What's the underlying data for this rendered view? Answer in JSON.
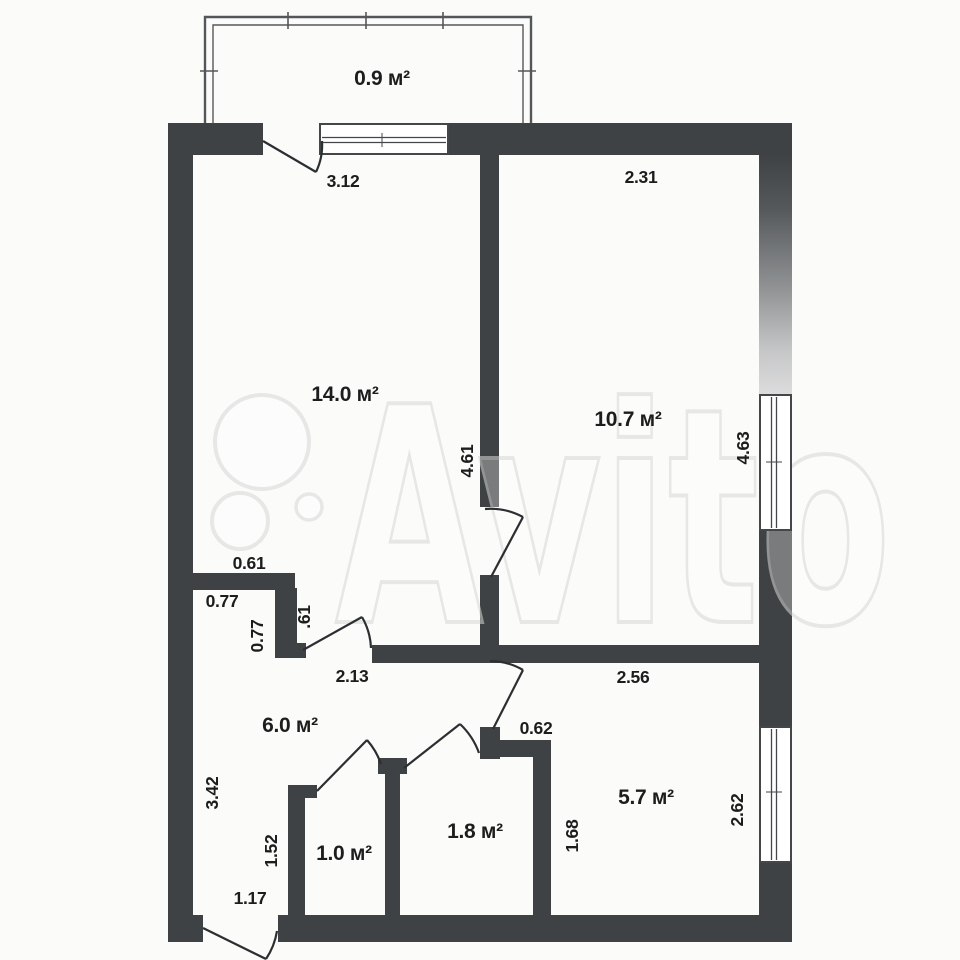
{
  "watermark": {
    "text": "Avito"
  },
  "rooms": {
    "balcony": {
      "area": "0.9 м²"
    },
    "living": {
      "area": "14.0 м²",
      "width": "3.12",
      "height": "4.61"
    },
    "bedroom": {
      "area": "10.7 м²",
      "width": "2.31",
      "height": "4.63"
    },
    "hall": {
      "area": "6.0 м²",
      "top_width": "2.13",
      "left_height": "3.42",
      "notch_top": "0.61",
      "notch_width": "0.77",
      "notch_height": "0.77",
      "notch_side": ".61",
      "entry_width": "1.17"
    },
    "closet_small": {
      "area": "1.0 м²",
      "left_height": "1.52"
    },
    "closet_large": {
      "area": "1.8 м²"
    },
    "kitchen": {
      "area": "5.7 м²",
      "top_width": "2.56",
      "door_width": "0.62",
      "left_height": "1.68",
      "right_height": "2.62"
    }
  },
  "colors": {
    "wall": "#3f4245",
    "background": "#fbfbfa",
    "watermark": "#d8d8d5"
  }
}
